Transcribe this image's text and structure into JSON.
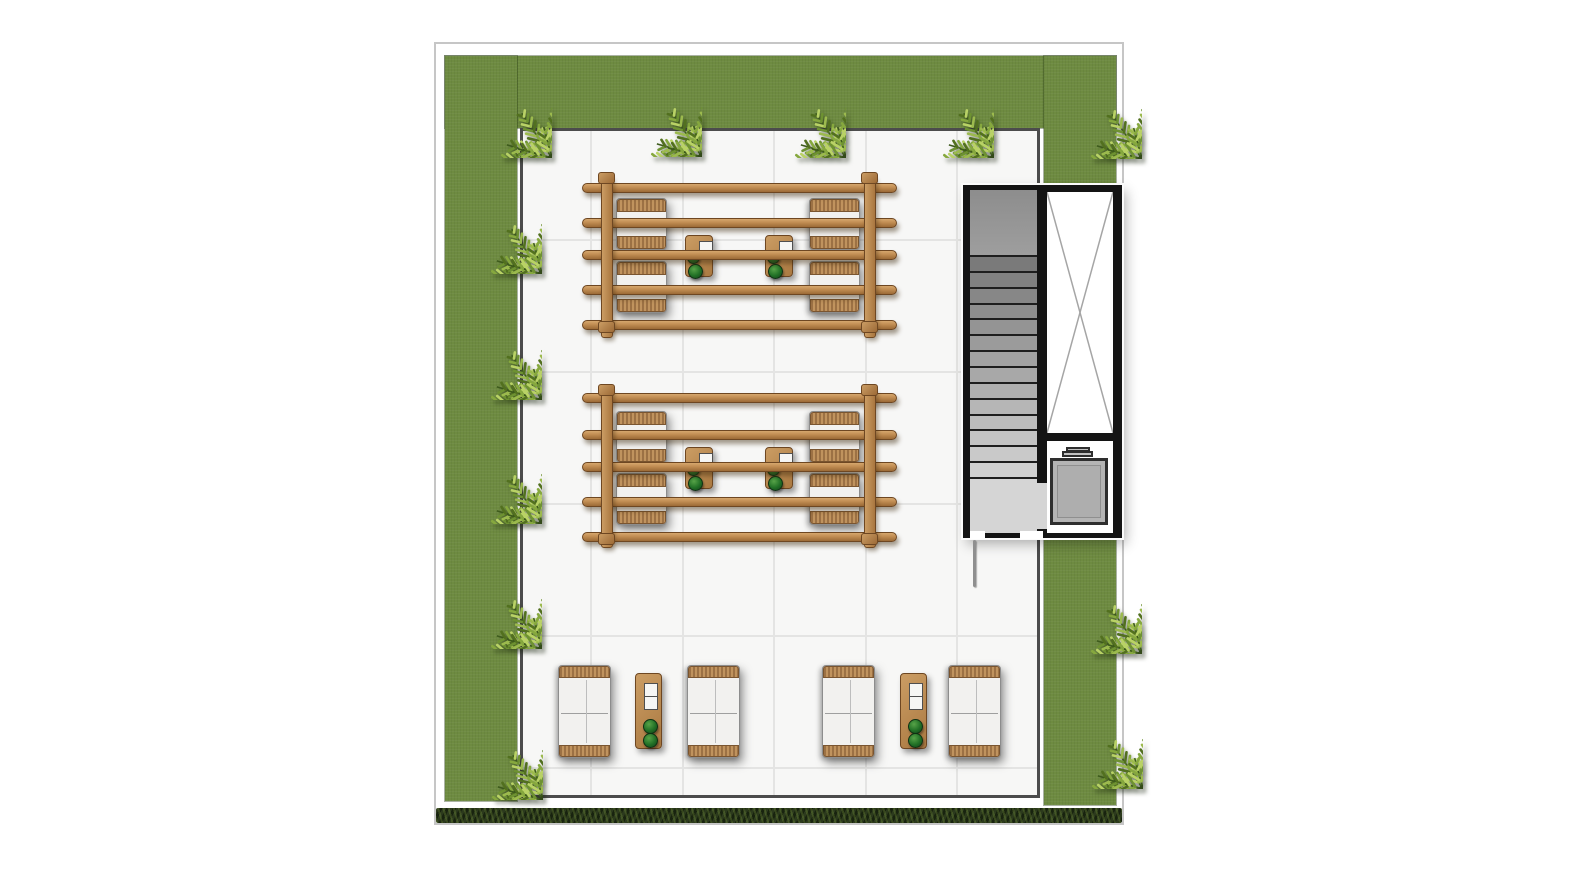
{
  "palette": {
    "page_bg": "#ffffff",
    "frame_border": "#c6c6c6",
    "grass": "#6e8b41",
    "terrace_fill": "#f7f7f6",
    "terrace_border": "#4c4c4c",
    "grid_line": "#e4e4e3",
    "wood": "#b88650",
    "wood_outline": "#6e4722",
    "cushion": "#f2f1ef",
    "wicker": "#c0935e",
    "core_wall": "#141414",
    "stair_tread_dark": "#7a7a7a",
    "stair_tread_light": "#d0d0d0",
    "elevator_line": "#a5a5a5",
    "tank_fill": "#b4b4b4",
    "plant_green": "#217026",
    "hedge": "#2c3a1d",
    "palm_leaf_bright": "#b9d266",
    "palm_leaf_dark": "#52701f"
  },
  "frame": {
    "x": 434,
    "y": 42,
    "w": 690,
    "h": 783
  },
  "grass_bands": [
    {
      "id": "top",
      "x": 445,
      "y": 56,
      "w": 671,
      "h": 72
    },
    {
      "id": "left",
      "x": 445,
      "y": 56,
      "w": 72,
      "h": 745
    },
    {
      "id": "right",
      "x": 1044,
      "y": 56,
      "w": 72,
      "h": 749
    }
  ],
  "palms": {
    "size": 124,
    "positions": [
      [
        490,
        96
      ],
      [
        640,
        95
      ],
      [
        784,
        96
      ],
      [
        932,
        96
      ],
      [
        1080,
        97
      ],
      [
        480,
        212
      ],
      [
        480,
        338
      ],
      [
        480,
        462
      ],
      [
        480,
        587
      ],
      [
        481,
        738
      ],
      [
        1080,
        592
      ],
      [
        1081,
        727
      ]
    ]
  },
  "terrace": {
    "x": 520,
    "y": 128,
    "w": 520,
    "h": 670,
    "grid_x": [
      590,
      682,
      773,
      865,
      956
    ],
    "grid_y": [
      239,
      371,
      503,
      635,
      767
    ]
  },
  "pergolas": [
    {
      "beams": {
        "x": 582,
        "w": 315,
        "h": 10,
        "ys": [
          183,
          218,
          250,
          285,
          320
        ]
      },
      "posts": {
        "w": 12,
        "xs": [
          601,
          864
        ],
        "y": 176,
        "h": 162
      },
      "caps": {
        "w": 17,
        "h": 12,
        "xs": [
          598,
          861
        ],
        "ys": [
          172,
          321
        ]
      },
      "chairs": {
        "w": 51,
        "h": 52,
        "positions": [
          [
            616,
            198
          ],
          [
            616,
            261
          ],
          [
            809,
            198
          ],
          [
            809,
            261
          ]
        ]
      },
      "tables": {
        "w": 28,
        "h": 42,
        "positions": [
          [
            685,
            235
          ],
          [
            765,
            235
          ]
        ]
      }
    },
    {
      "beams": {
        "x": 582,
        "w": 315,
        "h": 10,
        "ys": [
          393,
          430,
          462,
          497,
          532
        ]
      },
      "posts": {
        "w": 12,
        "xs": [
          601,
          864
        ],
        "y": 388,
        "h": 160
      },
      "caps": {
        "w": 17,
        "h": 12,
        "xs": [
          598,
          861
        ],
        "ys": [
          384,
          533
        ]
      },
      "chairs": {
        "w": 51,
        "h": 52,
        "positions": [
          [
            616,
            411
          ],
          [
            616,
            473
          ],
          [
            809,
            411
          ],
          [
            809,
            473
          ]
        ]
      },
      "tables": {
        "w": 28,
        "h": 42,
        "positions": [
          [
            685,
            447
          ],
          [
            765,
            447
          ]
        ]
      }
    }
  ],
  "pergola_table_detail": {
    "square": {
      "dx": 13,
      "dy": 5,
      "s": 12
    },
    "plants": [
      {
        "dx": 1,
        "dy": 15,
        "d": 11
      },
      {
        "dx": 2,
        "dy": 28,
        "d": 13
      }
    ]
  },
  "chair_wicker_h": 13,
  "core": {
    "outer": {
      "x": 963,
      "y": 185,
      "w": 159,
      "h": 353
    },
    "stair": {
      "x": 970,
      "y": 190,
      "w": 67,
      "h": 343,
      "top_landing_h": 65,
      "tread_count": 14,
      "treads_h": 222,
      "bottom_landing_h": 56
    },
    "divider_door": {
      "x": 1037,
      "y": 483,
      "w": 10,
      "h": 46
    },
    "elevator_cab": {
      "x": 1047,
      "y": 192,
      "w": 66,
      "h": 241
    },
    "tank_room": {
      "x": 1047,
      "y": 441,
      "w": 66,
      "h": 92
    },
    "tank": {
      "x": 1050,
      "y": 458,
      "w": 58,
      "h": 67
    },
    "lid": [
      {
        "x": 1066,
        "y": 447,
        "w": 24,
        "h": 5
      },
      {
        "x": 1062,
        "y": 451,
        "w": 31,
        "h": 6
      }
    ],
    "doors": [
      {
        "x": 970,
        "y": 531,
        "w": 15,
        "h": 8
      },
      {
        "x": 1020,
        "y": 531,
        "w": 23,
        "h": 8
      }
    ],
    "pull_line": {
      "x": 973,
      "y": 540,
      "w": 3,
      "h": 47
    }
  },
  "sofas": {
    "w": 53,
    "h": 93,
    "wicker_h": 12,
    "seam_y": 47,
    "positions": [
      [
        558,
        665
      ],
      [
        687,
        665
      ],
      [
        822,
        665
      ],
      [
        948,
        665
      ]
    ]
  },
  "side_tables": {
    "w": 27,
    "h": 76,
    "positions": [
      [
        635,
        673
      ],
      [
        900,
        673
      ]
    ],
    "squares": [
      {
        "dx": 8,
        "dy": 9,
        "s": 12
      },
      {
        "dx": 8,
        "dy": 22,
        "s": 12
      }
    ],
    "plants": [
      {
        "dx": 7,
        "dy": 45,
        "d": 13
      },
      {
        "dx": 7,
        "dy": 59,
        "d": 13
      }
    ]
  },
  "hedge": {
    "x": 436,
    "y": 808,
    "w": 686,
    "h": 15
  }
}
